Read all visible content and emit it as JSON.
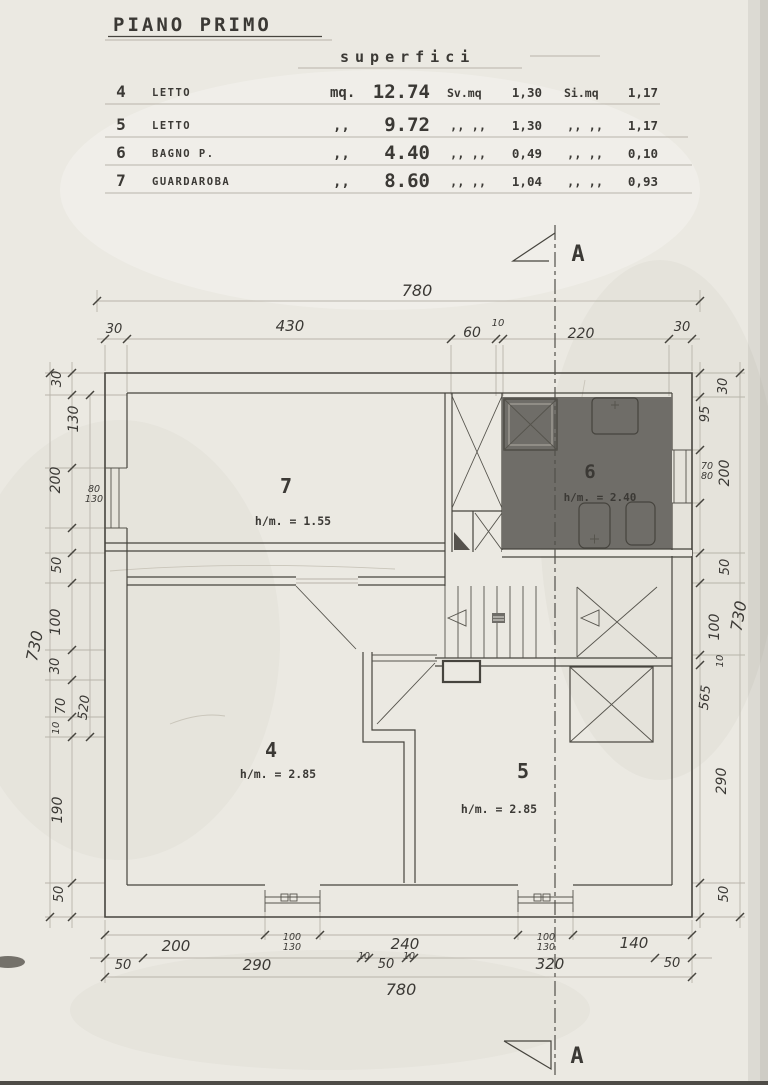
{
  "colors": {
    "paper": "#ebe9e2",
    "ink": "#46443e",
    "pencil": "#b8b4aa",
    "bath_fill": "#6f6d68"
  },
  "table": {
    "title": "PIANO PRIMO",
    "subtitle": "superfici",
    "rows": [
      {
        "num": "4",
        "name": "LETTO",
        "unit": "mq.",
        "area": "12.74",
        "sv_label": "Sv.mq",
        "sv": "1,30",
        "si_label": "Si.mq",
        "si": "1,17"
      },
      {
        "num": "5",
        "name": "LETTO",
        "unit": ",,",
        "area": "9.72",
        "sv_label": ",,   ,,",
        "sv": "1,30",
        "si_label": ",,   ,,",
        "si": "1,17"
      },
      {
        "num": "6",
        "name": "BAGNO P.",
        "unit": ",,",
        "area": "4.40",
        "sv_label": ",,   ,,",
        "sv": "0,49",
        "si_label": ",,   ,,",
        "si": "0,10"
      },
      {
        "num": "7",
        "name": "GUARDAROBA",
        "unit": ",,",
        "area": "8.60",
        "sv_label": ",,   ,,",
        "sv": "1,04",
        "si_label": ",,   ,,",
        "si": "0,93"
      }
    ]
  },
  "rooms": {
    "r7": {
      "num": "7",
      "height": "h/m. = 1.55"
    },
    "r6": {
      "num": "6",
      "height": "h/m. = 2.40"
    },
    "r4": {
      "num": "4",
      "height": "h/m. = 2.85"
    },
    "r5": {
      "num": "5",
      "height": "h/m. = 2.85"
    }
  },
  "section": {
    "label": "A"
  },
  "dims": {
    "top": {
      "overall": "780",
      "seg": [
        "30",
        "430",
        "60",
        "10",
        "220",
        "30"
      ]
    },
    "bottom": {
      "overall": "780",
      "row1": [
        "200",
        "240",
        "140"
      ],
      "win1_w": "100",
      "win1_h": "130",
      "win2_w": "100",
      "win2_h": "130",
      "row2": [
        "50",
        "290",
        "10",
        "50",
        "10",
        "320",
        "50"
      ]
    },
    "left": {
      "overall": "730",
      "bracket": "520",
      "win_w": "80",
      "win_h": "130",
      "seg": [
        "30",
        "130",
        "200",
        "50",
        "100",
        "30",
        "70",
        "10",
        "190",
        "50"
      ]
    },
    "right": {
      "overall": "730",
      "bracket": "565",
      "win_w": "70",
      "win_h": "80",
      "seg": [
        "30",
        "95",
        "200",
        "50",
        "100",
        "10",
        "290",
        "50"
      ]
    }
  }
}
